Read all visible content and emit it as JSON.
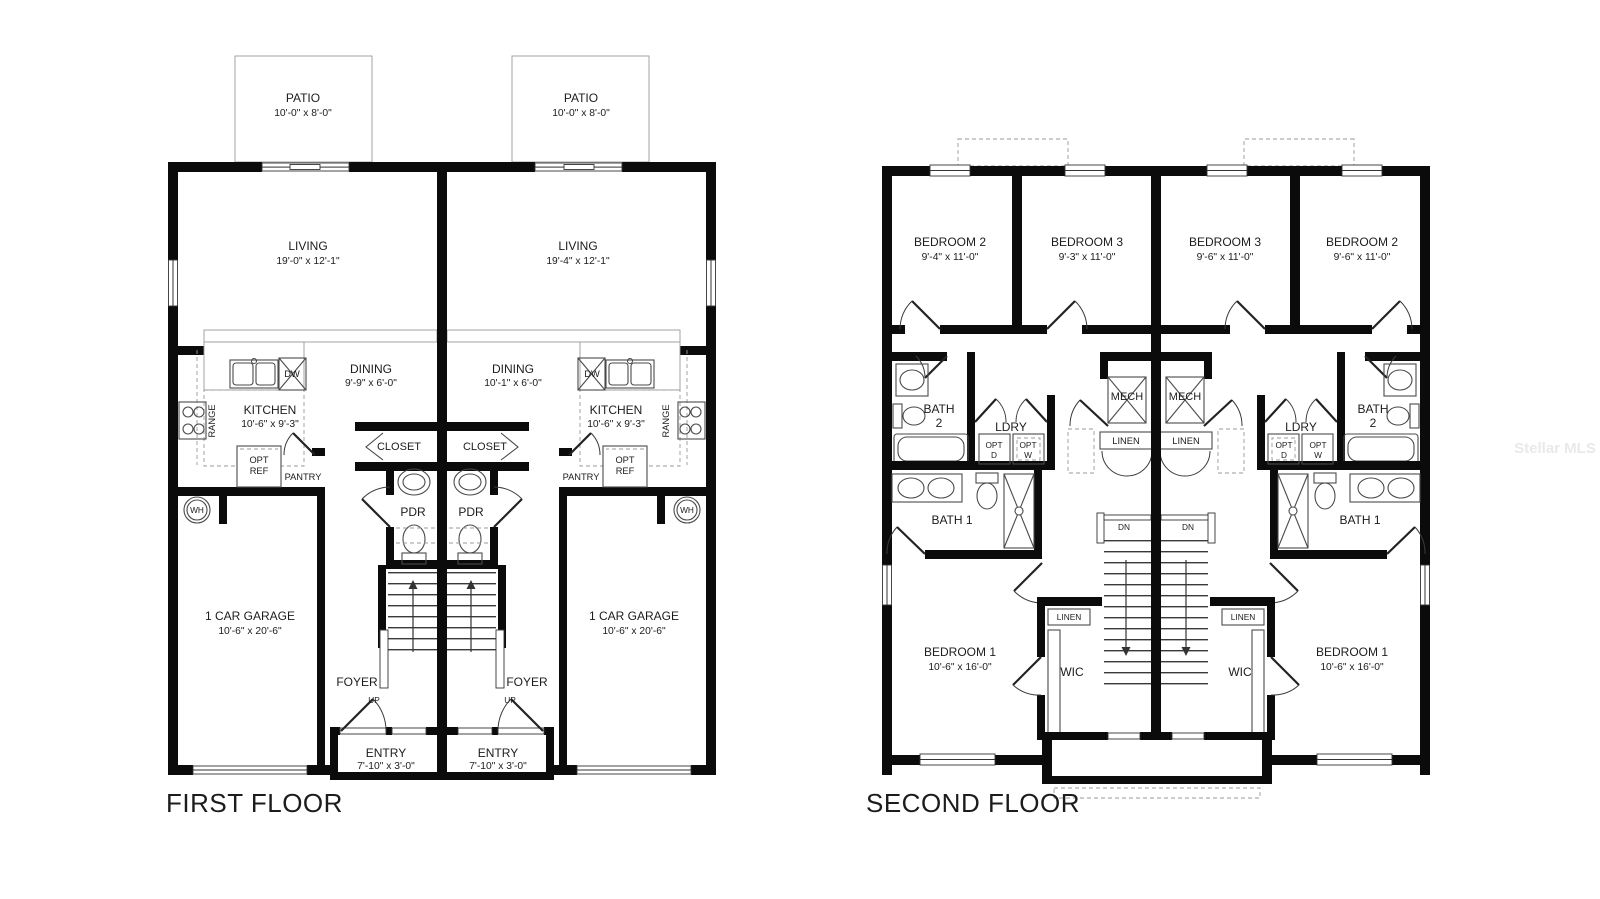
{
  "watermark": "Stellar MLS",
  "first_floor": {
    "title": "FIRST FLOOR",
    "left": {
      "patio_name": "PATIO",
      "patio_dims": "10'-0\" x 8'-0\"",
      "living_name": "LIVING",
      "living_dims": "19'-0\" x 12'-1\"",
      "dining_name": "DINING",
      "dining_dims": "9'-9\" x 6'-0\"",
      "kitchen_name": "KITCHEN",
      "kitchen_dims": "10'-6\" x 9'-3\"",
      "range_label": "RANGE",
      "dw_label": "DW",
      "opt_ref_line1": "OPT",
      "opt_ref_line2": "REF",
      "pantry_label": "PANTRY",
      "wh_label": "WH",
      "closet_label": "CLOSET",
      "pdr_label": "PDR",
      "garage_name": "1 CAR GARAGE",
      "garage_dims": "10'-6\" x 20'-6\"",
      "foyer_label": "FOYER",
      "up_label": "UP",
      "entry_name": "ENTRY",
      "entry_dims": "7'-10\" x 3'-0\""
    },
    "right": {
      "patio_name": "PATIO",
      "patio_dims": "10'-0\" x 8'-0\"",
      "living_name": "LIVING",
      "living_dims": "19'-4\" x 12'-1\"",
      "dining_name": "DINING",
      "dining_dims": "10'-1\" x 6'-0\"",
      "kitchen_name": "KITCHEN",
      "kitchen_dims": "10'-6\" x 9'-3\"",
      "range_label": "RANGE",
      "dw_label": "DW",
      "opt_ref_line1": "OPT",
      "opt_ref_line2": "REF",
      "pantry_label": "PANTRY",
      "wh_label": "WH",
      "closet_label": "CLOSET",
      "pdr_label": "PDR",
      "garage_name": "1 CAR GARAGE",
      "garage_dims": "10'-6\" x 20'-6\"",
      "foyer_label": "FOYER",
      "up_label": "UP",
      "entry_name": "ENTRY",
      "entry_dims": "7'-10\" x 3'-0\""
    }
  },
  "second_floor": {
    "title": "SECOND FLOOR",
    "left": {
      "bedroom2_name": "BEDROOM 2",
      "bedroom2_dims": "9'-4\" x 11'-0\"",
      "bedroom3_name": "BEDROOM 3",
      "bedroom3_dims": "9'-3\" x 11'-0\"",
      "bath2_line1": "BATH",
      "bath2_line2": "2",
      "ldry_label": "LDRY",
      "opt_d_line1": "OPT",
      "opt_d_line2": "D",
      "opt_w_line1": "OPT",
      "opt_w_line2": "W",
      "mech_label": "MECH",
      "linen_hall_label": "LINEN",
      "bath1_label": "BATH 1",
      "dn_label": "DN",
      "linen_wic_label": "LINEN",
      "wic_label": "WIC",
      "bedroom1_name": "BEDROOM 1",
      "bedroom1_dims": "10'-6\" x 16'-0\""
    },
    "right": {
      "bedroom2_name": "BEDROOM 2",
      "bedroom2_dims": "9'-6\" x 11'-0\"",
      "bedroom3_name": "BEDROOM 3",
      "bedroom3_dims": "9'-6\" x 11'-0\"",
      "bath2_line1": "BATH",
      "bath2_line2": "2",
      "ldry_label": "LDRY",
      "opt_d_line1": "OPT",
      "opt_d_line2": "D",
      "opt_w_line1": "OPT",
      "opt_w_line2": "W",
      "mech_label": "MECH",
      "linen_hall_label": "LINEN",
      "bath1_label": "BATH 1",
      "dn_label": "DN",
      "linen_wic_label": "LINEN",
      "wic_label": "WIC",
      "bedroom1_name": "BEDROOM 1",
      "bedroom1_dims": "10'-6\" x 16'-0\""
    }
  }
}
